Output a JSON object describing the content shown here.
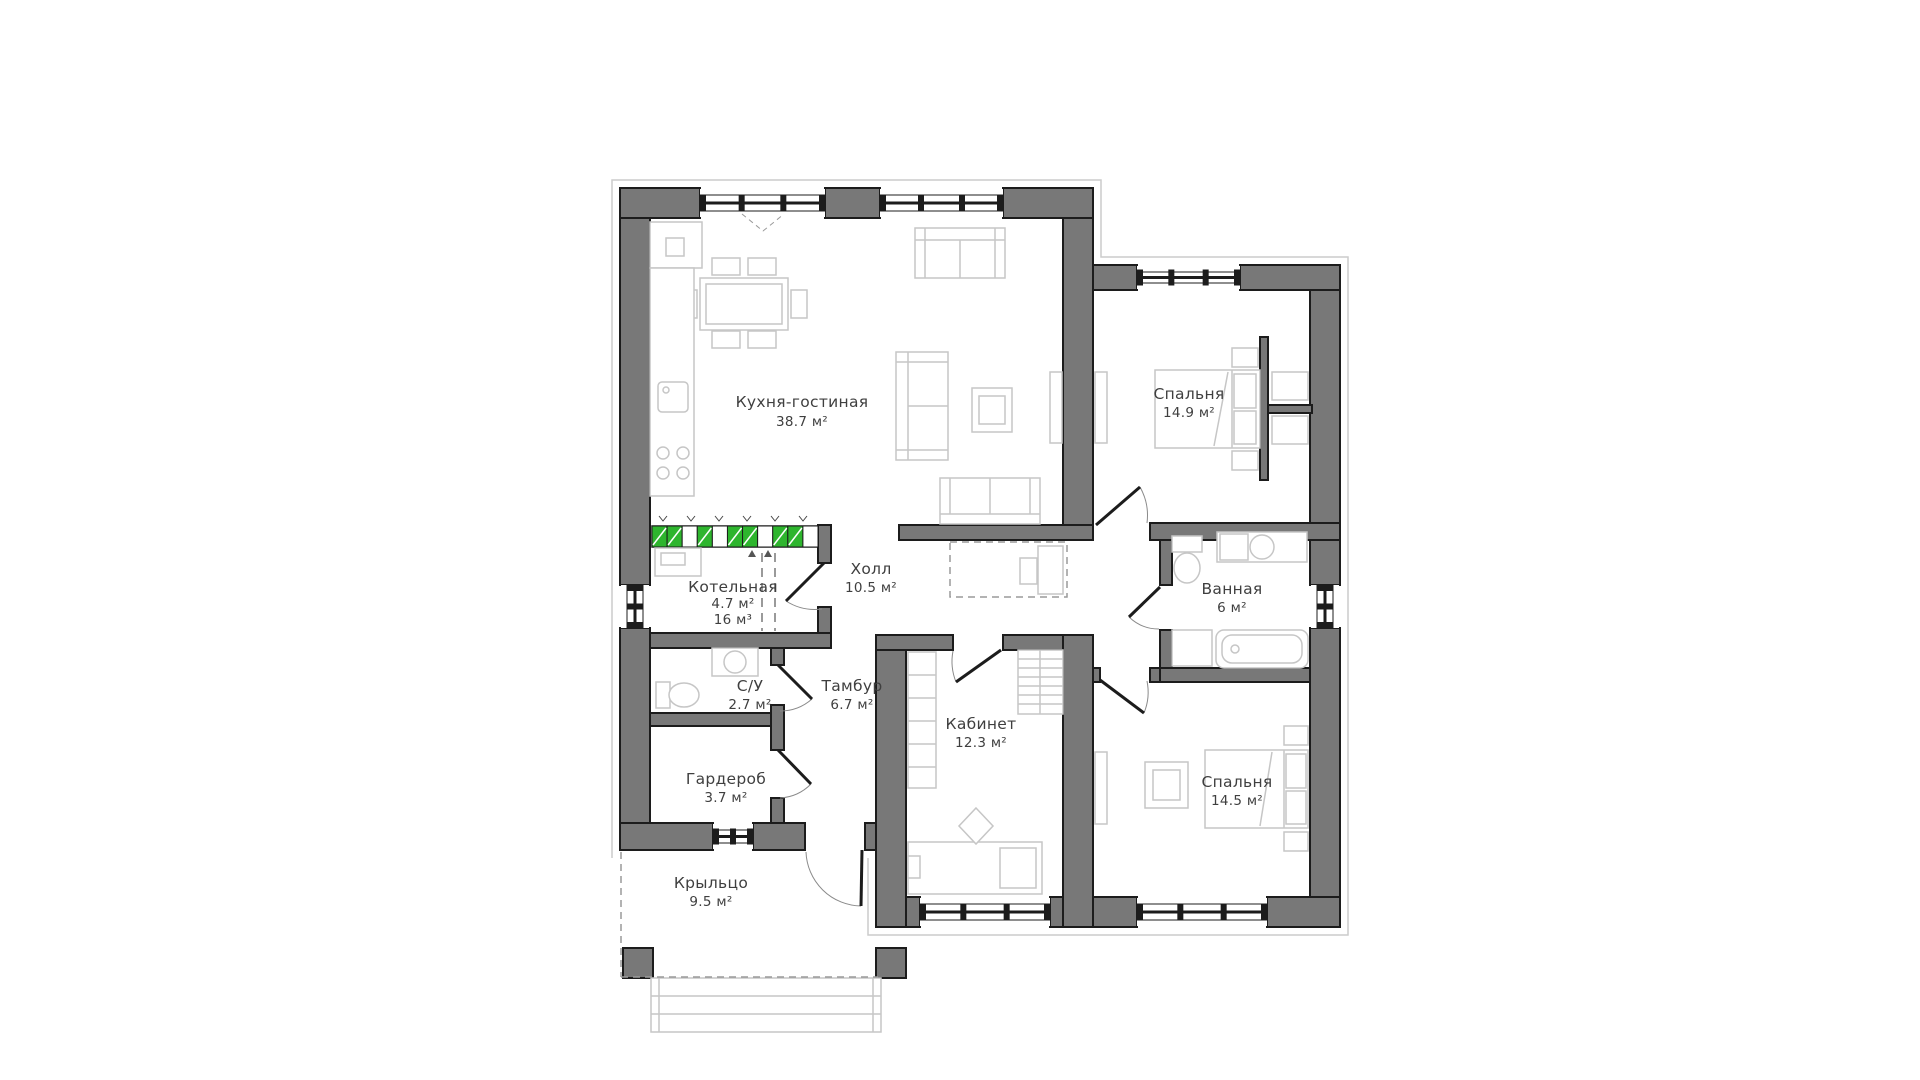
{
  "document": {
    "type": "architectural-floor-plan",
    "background": "#ffffff"
  },
  "colors": {
    "wall": "#787878",
    "outline": "#1c1c1c",
    "furniture_line": "#c6c6c6",
    "dash_line": "#9a9a9a",
    "door_arc": "#8a8a8a",
    "radiator_green": "#2eb52e",
    "text": "#3f3f3f"
  },
  "rooms": [
    {
      "id": "kitchen-living",
      "name": "Кухня-гостиная",
      "area": "38.7 м²"
    },
    {
      "id": "bedroom-top",
      "name": "Спальня",
      "area": "14.9 м²"
    },
    {
      "id": "hall",
      "name": "Холл",
      "area": "10.5 м²"
    },
    {
      "id": "boiler-room",
      "name": "Котельная",
      "area": "4.7 м²",
      "volume": "16 м³"
    },
    {
      "id": "bathroom",
      "name": "Ванная",
      "area": "6 м²"
    },
    {
      "id": "wc",
      "name": "С/У",
      "area": "2.7 м²"
    },
    {
      "id": "vestibule",
      "name": "Тамбур",
      "area": "6.7 м²"
    },
    {
      "id": "study",
      "name": "Кабинет",
      "area": "12.3 м²"
    },
    {
      "id": "wardrobe-room",
      "name": "Гардероб",
      "area": "3.7 м²"
    },
    {
      "id": "bedroom-bottom",
      "name": "Спальня",
      "area": "14.5 м²"
    },
    {
      "id": "porch",
      "name": "Крыльцо",
      "area": "9.5 м²"
    }
  ]
}
